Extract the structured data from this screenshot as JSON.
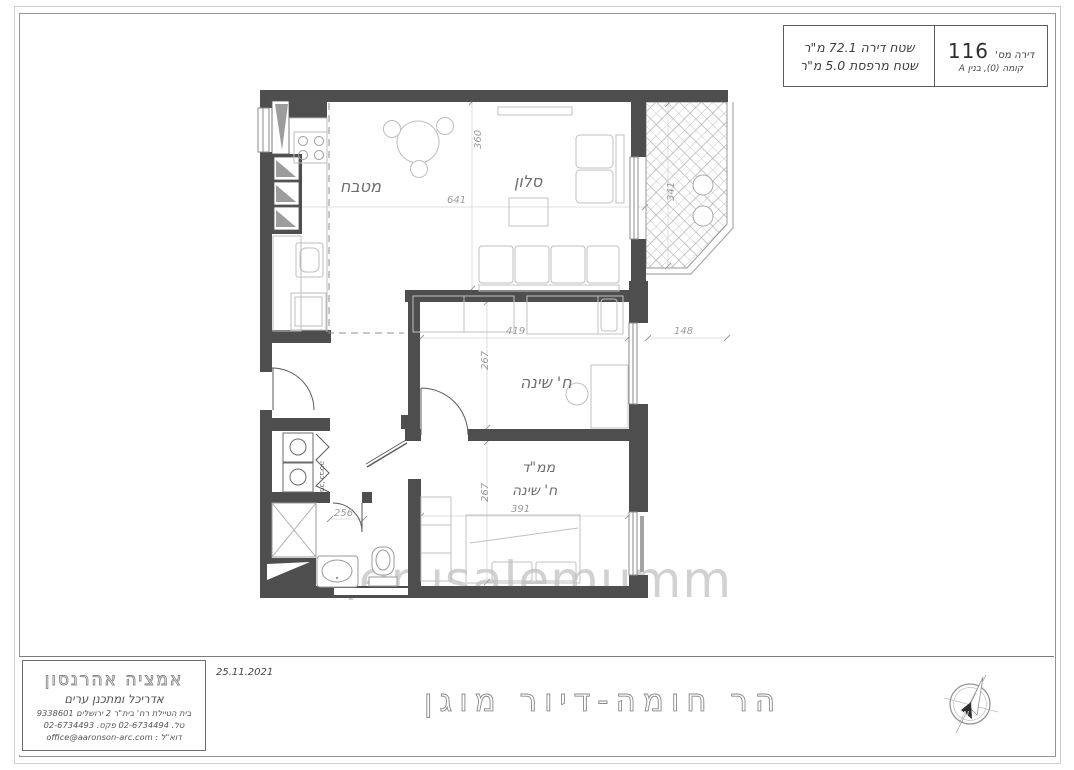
{
  "header": {
    "apartment_label": "דירה מס'",
    "apartment_number": "116",
    "floor_line": "קומה (0), בנין A",
    "area_line1": "שטח דירה 72.1 מ\"ר",
    "area_line2": "שטח מרפסת 5.0 מ\"ר"
  },
  "plan": {
    "labels": {
      "kitchen": "מטבח",
      "living": "סלון",
      "bedroom": "ח' שינה",
      "mamad_line1": "ממ\"ד",
      "mamad_line2": "ח' שינה",
      "laundry": "מכ' כביסה"
    },
    "dims": {
      "living_height": "360",
      "living_width": "641",
      "balcony_depth": "341",
      "bedroom_width": "419",
      "bedroom_height": "267",
      "side_offset": "148",
      "mamad_height": "267",
      "mamad_width": "391",
      "hallway_width": "256"
    },
    "watermark": "jerusalemumm"
  },
  "titleblock": {
    "architect_name": "אמציה אהרנסון",
    "architect_role": "אדריכל ומתכנן ערים",
    "address": "בית הטיילת רח' בית\"ר 2 ירושלים 9338601",
    "phone": "טל. 02-6734494 פקס. 02-6734493",
    "email": "דוא\"ל : office@aaronson-arc.com",
    "date": "25.11.2021",
    "project_title": "הר חומה-דיור מוגן"
  },
  "icons": {
    "compass": "north-arrow-icon",
    "compass_letter": "N"
  }
}
